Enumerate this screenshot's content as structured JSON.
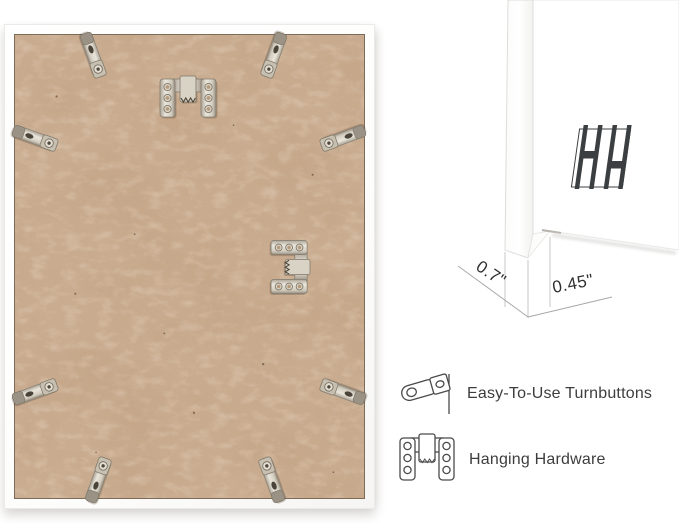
{
  "product_view": {
    "description_not_text": "back of white picture frame with kraft MDF backing",
    "turnbutton_count": 8,
    "hanging_hardware_count": 2
  },
  "dimensions": {
    "depth_label": "0.7\"",
    "face_label": "0.45\""
  },
  "logo": {
    "icon": "hh-logo"
  },
  "legend": {
    "items": [
      {
        "icon": "turnbutton-icon",
        "label": "Easy-To-Use Turnbuttons"
      },
      {
        "icon": "hanging-hardware-icon",
        "label": "Hanging Hardware"
      }
    ]
  },
  "colors": {
    "backing": "#c6a78a",
    "frame_white": "#ffffff",
    "metal": "#cfc8bb",
    "annotation_text": "#2f2f2f",
    "legend_text": "#3d3d3d",
    "dim_line": "#b5b5b5"
  }
}
